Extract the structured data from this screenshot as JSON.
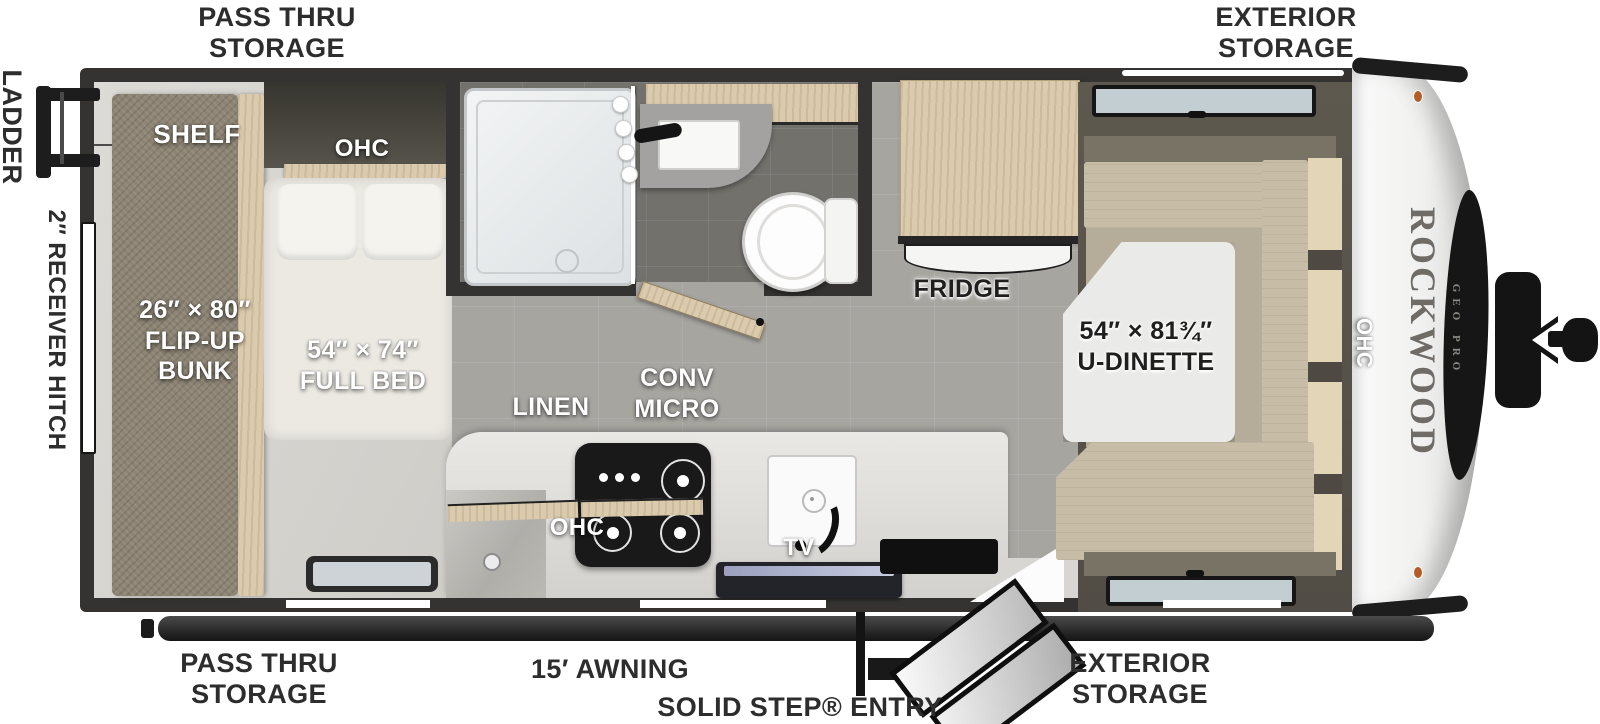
{
  "title": "Rockwood Geo Pro travel trailer floor plan",
  "exterior_labels": {
    "pass_thru_storage_top": "PASS THRU\nSTORAGE",
    "exterior_storage_top": "EXTERIOR\nSTORAGE",
    "ladder": "LADDER",
    "receiver_hitch": "2″ RECEIVER HITCH",
    "pass_thru_storage_bottom": "PASS THRU\nSTORAGE",
    "awning": "15′ AWNING",
    "solid_step_entry": "SOLID STEP® ENTRY",
    "exterior_storage_bottom": "EXTERIOR\nSTORAGE"
  },
  "interior_labels": {
    "shelf": "SHELF",
    "ohc_bedroom": "OHC",
    "flip_up_bunk": "26″ × 80″\nFLIP-UP\nBUNK",
    "full_bed": "54″ × 74″\nFULL BED",
    "linen": "LINEN",
    "conv_micro": "CONV\nMICRO",
    "ohc_kitchen": "OHC",
    "tv": "TV",
    "fridge": "FRIDGE",
    "u_dinette": "54″ × 81¾″\nU-DINETTE",
    "ohc_dinette": "OHC"
  },
  "branding": {
    "make": "ROCKWOOD",
    "series": "GEO PRO"
  },
  "colors": {
    "wall": "#343331",
    "floor_main": "#a7a5a0",
    "floor_bedroom": "#d9d7d2",
    "bath_floor": "#72716c",
    "wood": "#dbcbae",
    "cushion": "#c7bda7",
    "cushion_dark": "#787365",
    "counter": "#e3e2df",
    "table": "#eaeae8",
    "mattress": "#ece9e3",
    "cap": "#f2f2f1",
    "black": "#161616"
  }
}
